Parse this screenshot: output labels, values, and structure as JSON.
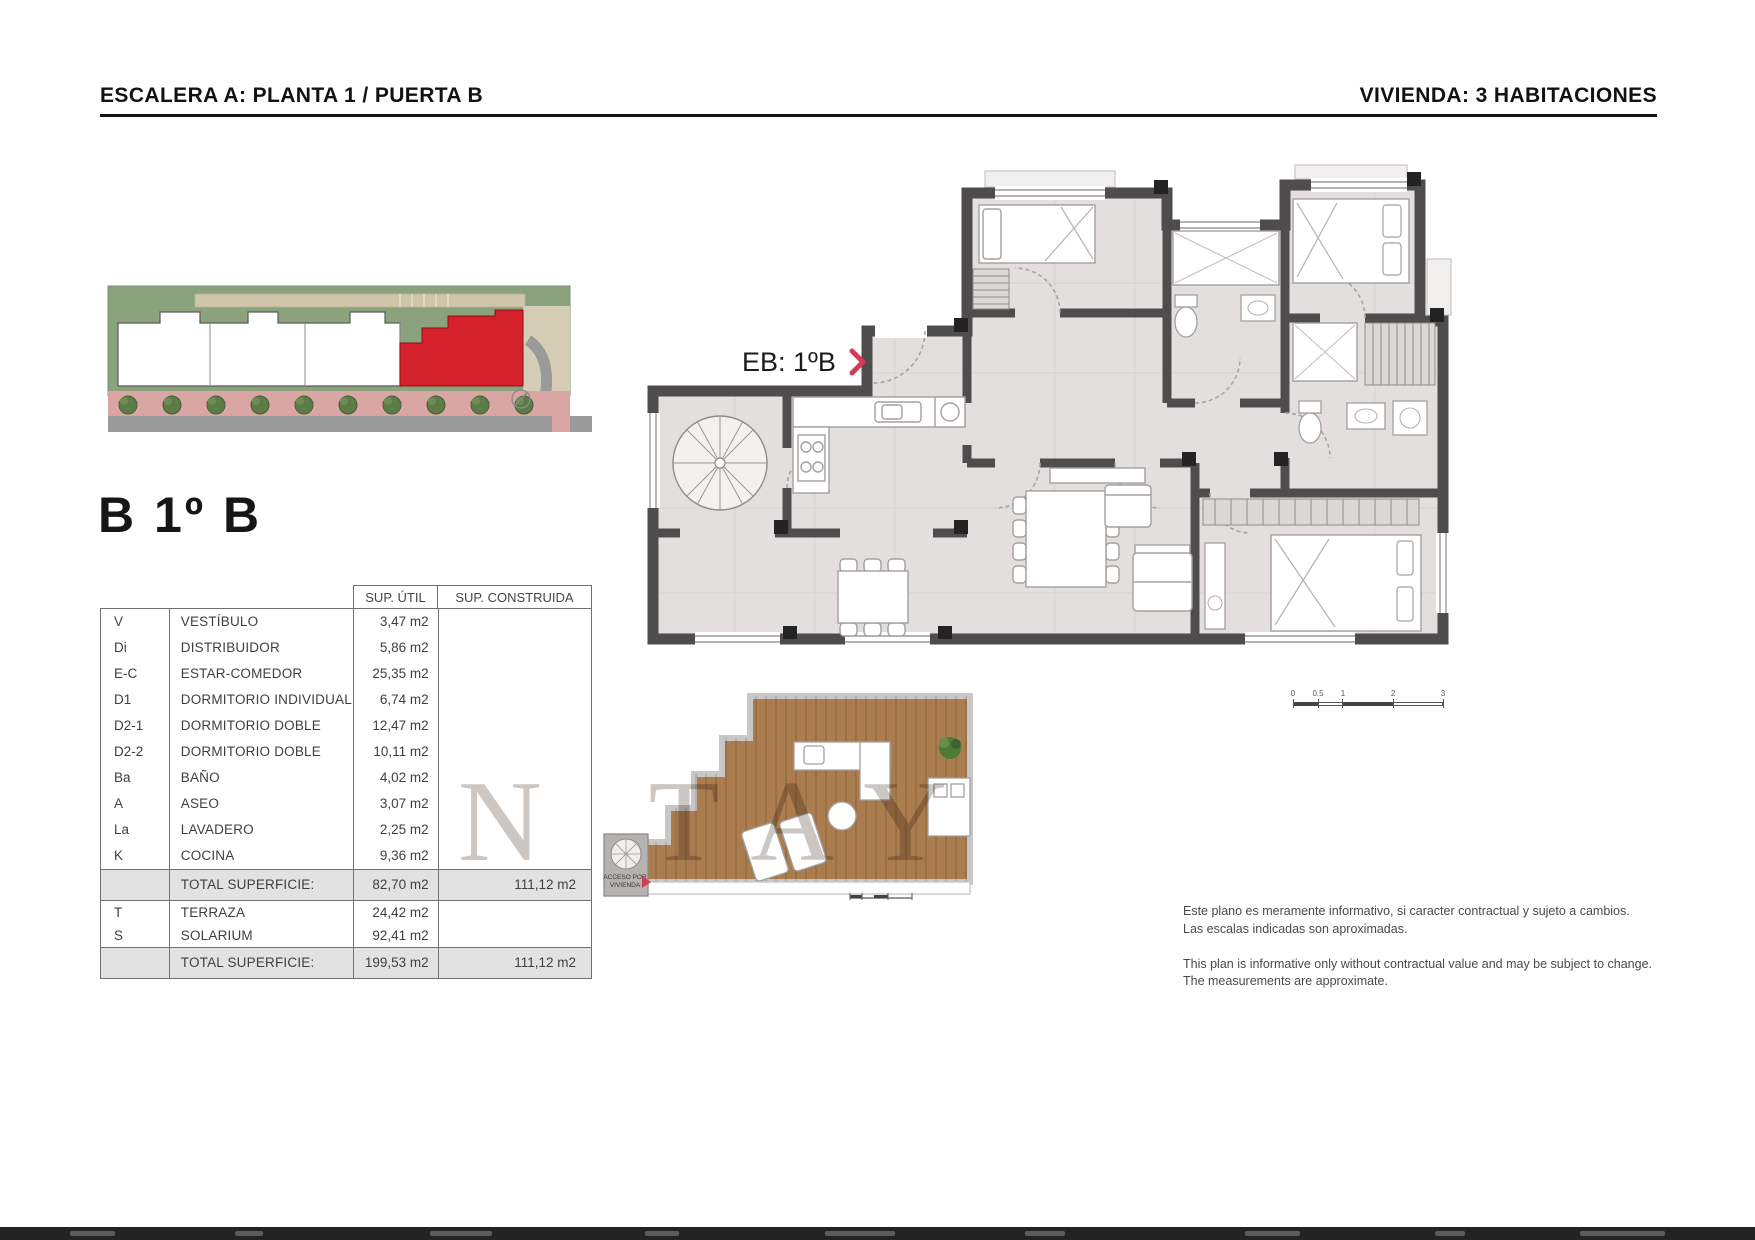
{
  "header": {
    "left_title": "ESCALERA A: PLANTA 1 / PUERTA B",
    "right_title": "VIVIENDA: 3 HABITACIONES"
  },
  "unit": {
    "title": "B 1º B",
    "plan_label": "EB: 1ºB",
    "access_label_line1": "ACCESO POR",
    "access_label_line2": "VIVIENDA"
  },
  "table": {
    "headers": {
      "util": "SUP. ÚTIL",
      "construida": "SUP. CONSTRUIDA"
    },
    "rows": [
      {
        "code": "V",
        "name": "VESTÍBULO",
        "util": "3,47 m2"
      },
      {
        "code": "Di",
        "name": "DISTRIBUIDOR",
        "util": "5,86 m2"
      },
      {
        "code": "E-C",
        "name": "ESTAR-COMEDOR",
        "util": "25,35 m2"
      },
      {
        "code": "D1",
        "name": "DORMITORIO INDIVIDUAL",
        "util": "6,74 m2"
      },
      {
        "code": "D2-1",
        "name": "DORMITORIO DOBLE",
        "util": "12,47 m2"
      },
      {
        "code": "D2-2",
        "name": "DORMITORIO DOBLE",
        "util": "10,11 m2"
      },
      {
        "code": "Ba",
        "name": "BAÑO",
        "util": "4,02 m2"
      },
      {
        "code": "A",
        "name": "ASEO",
        "util": "3,07 m2"
      },
      {
        "code": "La",
        "name": "LAVADERO",
        "util": "2,25 m2"
      },
      {
        "code": "K",
        "name": "COCINA",
        "util": "9,36 m2"
      }
    ],
    "subtotal": {
      "label": "TOTAL SUPERFICIE:",
      "util": "82,70 m2",
      "construida": "111,12 m2"
    },
    "outdoor_rows": [
      {
        "code": "T",
        "name": "TERRAZA",
        "util": "24,42 m2"
      },
      {
        "code": "S",
        "name": "SOLARIUM",
        "util": "92,41 m2"
      }
    ],
    "total": {
      "label": "TOTAL SUPERFICIE:",
      "util": "199,53 m2",
      "construida": "111,12 m2"
    }
  },
  "scalebar": {
    "ticks": [
      "0",
      "0.5",
      "1",
      "2",
      "3"
    ]
  },
  "disclaimer": {
    "es_line1": "Este plano es meramente informativo, si caracter contractual y sujeto a cambios.",
    "es_line2": "Las escalas indicadas son aproximadas.",
    "en_line1": "This plan is informative only without contractual value and may be subject to change.",
    "en_line2": "The measurements are approximate."
  },
  "watermark": "N TAY",
  "colors": {
    "accent_red": "#d5212b",
    "arrow_red": "#d63a52",
    "wall": "#4f4c4d",
    "floor": "#e3dfde",
    "deck_wood": "#aa7c4e",
    "table_total_bg": "#e2e2e2"
  }
}
